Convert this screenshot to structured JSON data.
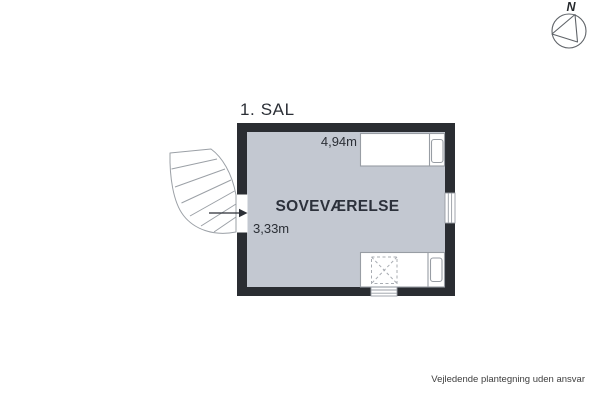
{
  "compass": {
    "north_label": "N"
  },
  "plan": {
    "floor_label": "1. SAL",
    "room": {
      "name": "SOVEVÆRELSE",
      "width_dimension": "4,94m",
      "depth_dimension": "3,33m"
    },
    "features": [
      "winder-staircase",
      "entry-door-with-arrow",
      "window-right-wall",
      "window-bottom-wall",
      "single-bed-top",
      "single-bed-bottom",
      "dashed-skylight-over-bed"
    ]
  },
  "footer": {
    "disclaimer": "Vejledende plantegning uden ansvar"
  },
  "colors": {
    "wall": "#2a2d32",
    "floor": "#c3c8d1",
    "outline": "#989da4",
    "stair_outline": "#9ba0a6",
    "dashed": "#a8acb2",
    "text": "#2b2f36",
    "room_text": "#2c313b",
    "footer_text": "#3e3e3e",
    "compass": "#5f6368"
  }
}
